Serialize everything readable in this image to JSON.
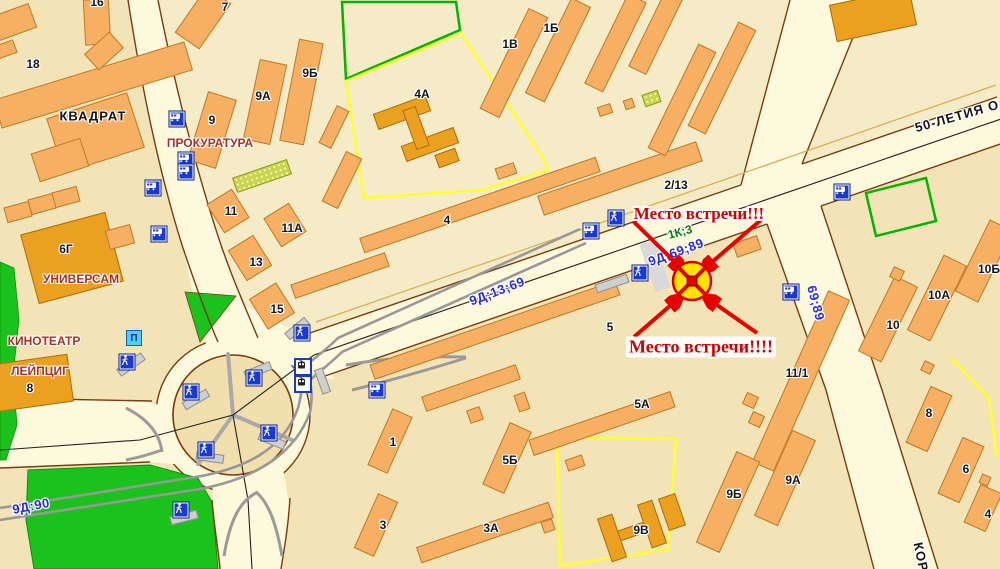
{
  "annotation": {
    "label_top": "Место встречи!!!",
    "label_bottom": "Место встречи!!!!",
    "marker": {
      "x": 692,
      "y": 281
    },
    "arrow_color": "#E60000",
    "marker_fill": "#FFE400",
    "marker_cross": "#DD0000"
  },
  "colors": {
    "block_base": "#F2E4B6",
    "block_light": "#F5EBC6",
    "road": "#FDF9DC",
    "road_edge": "#7A3B10",
    "building": "#F6AF63",
    "building_public": "#ECA01F",
    "park": "#1CC21C",
    "tram_track": "#989898",
    "street_text_blue": "#2A2ADF",
    "outline_green": "#00B400",
    "outline_yellow": "#FFFF30"
  },
  "street_labels": [
    {
      "t": "50-ЛЕТИЯ О",
      "x": 957,
      "y": 116,
      "r": -16,
      "c": "black"
    },
    {
      "t": "КОР",
      "x": 921,
      "y": 557,
      "r": 78,
      "c": "black"
    },
    {
      "t": "9Д;13;69",
      "x": 497,
      "y": 291,
      "r": -21,
      "c": "blue"
    },
    {
      "t": "9Д;69;89",
      "x": 676,
      "y": 252,
      "r": -20,
      "c": "blue"
    },
    {
      "t": "69;89",
      "x": 816,
      "y": 303,
      "r": 75,
      "c": "blue"
    },
    {
      "t": "9Д:90",
      "x": 31,
      "y": 506,
      "r": -11,
      "c": "blue"
    },
    {
      "t": "1К;3",
      "x": 680,
      "y": 232,
      "r": -15,
      "c": "green"
    }
  ],
  "poi_labels": [
    {
      "t": "КВАДРАТ",
      "x": 93,
      "y": 116,
      "c": "black"
    },
    {
      "t": "ПРОКУРАТУРА",
      "x": 210,
      "y": 143,
      "c": "red"
    },
    {
      "t": "УНИВЕРСАМ",
      "x": 81,
      "y": 279,
      "c": "red"
    },
    {
      "t": "КИНОТЕАТР",
      "x": 44,
      "y": 341,
      "c": "red"
    },
    {
      "t": "ЛЕЙПЦИГ",
      "x": 40,
      "y": 371,
      "c": "red"
    }
  ],
  "building_labels": [
    {
      "t": "18",
      "x": 33,
      "y": 64
    },
    {
      "t": "16",
      "x": 97,
      "y": 2
    },
    {
      "t": "7",
      "x": 225,
      "y": 7
    },
    {
      "t": "9Б",
      "x": 310,
      "y": 73
    },
    {
      "t": "9А",
      "x": 263,
      "y": 96
    },
    {
      "t": "9",
      "x": 212,
      "y": 120
    },
    {
      "t": "11",
      "x": 231,
      "y": 211
    },
    {
      "t": "11А",
      "x": 292,
      "y": 228
    },
    {
      "t": "13",
      "x": 256,
      "y": 262
    },
    {
      "t": "15",
      "x": 277,
      "y": 309
    },
    {
      "t": "6Г",
      "x": 66,
      "y": 249
    },
    {
      "t": "8",
      "x": 30,
      "y": 388
    },
    {
      "t": "4А",
      "x": 422,
      "y": 94
    },
    {
      "t": "1В",
      "x": 510,
      "y": 44
    },
    {
      "t": "1Б",
      "x": 551,
      "y": 28
    },
    {
      "t": "4",
      "x": 447,
      "y": 220
    },
    {
      "t": "2/13",
      "x": 676,
      "y": 185
    },
    {
      "t": "5",
      "x": 610,
      "y": 327
    },
    {
      "t": "5А",
      "x": 642,
      "y": 404
    },
    {
      "t": "5Б",
      "x": 510,
      "y": 460
    },
    {
      "t": "3А",
      "x": 491,
      "y": 528
    },
    {
      "t": "1",
      "x": 393,
      "y": 442
    },
    {
      "t": "3",
      "x": 383,
      "y": 525
    },
    {
      "t": "9В",
      "x": 641,
      "y": 530
    },
    {
      "t": "11/1",
      "x": 797,
      "y": 373
    },
    {
      "t": "9Б",
      "x": 734,
      "y": 494
    },
    {
      "t": "9А",
      "x": 793,
      "y": 480
    },
    {
      "t": "10",
      "x": 893,
      "y": 325
    },
    {
      "t": "10А",
      "x": 939,
      "y": 295
    },
    {
      "t": "10Б",
      "x": 989,
      "y": 269
    },
    {
      "t": "8",
      "x": 929,
      "y": 413
    },
    {
      "t": "6",
      "x": 966,
      "y": 469
    },
    {
      "t": "4",
      "x": 988,
      "y": 514
    }
  ],
  "icons": [
    {
      "k": "bus",
      "x": 177,
      "y": 119
    },
    {
      "k": "bus",
      "x": 153,
      "y": 188
    },
    {
      "k": "bus",
      "x": 159,
      "y": 234
    },
    {
      "k": "bus",
      "x": 186,
      "y": 160
    },
    {
      "k": "bus",
      "x": 186,
      "y": 172
    },
    {
      "k": "bus",
      "x": 591,
      "y": 231
    },
    {
      "k": "bus",
      "x": 842,
      "y": 192
    },
    {
      "k": "bus",
      "x": 791,
      "y": 292
    },
    {
      "k": "bus",
      "x": 377,
      "y": 390
    },
    {
      "k": "tram",
      "x": 303,
      "y": 367
    },
    {
      "k": "tram",
      "x": 303,
      "y": 384
    },
    {
      "k": "ped",
      "x": 616,
      "y": 218
    },
    {
      "k": "ped",
      "x": 640,
      "y": 273
    },
    {
      "k": "ped",
      "x": 127,
      "y": 362
    },
    {
      "k": "ped",
      "x": 191,
      "y": 392
    },
    {
      "k": "ped",
      "x": 254,
      "y": 378
    },
    {
      "k": "ped",
      "x": 269,
      "y": 433
    },
    {
      "k": "ped",
      "x": 206,
      "y": 450
    },
    {
      "k": "ped",
      "x": 181,
      "y": 510
    },
    {
      "k": "ped",
      "x": 302,
      "y": 333
    },
    {
      "k": "park",
      "x": 134,
      "y": 338,
      "label": "П"
    }
  ],
  "buildings": [
    {
      "x": 93,
      "y": 85,
      "w": 200,
      "h": 30,
      "r": -17
    },
    {
      "x": 14,
      "y": 22,
      "w": 40,
      "h": 26,
      "r": -20
    },
    {
      "x": 4,
      "y": 50,
      "w": 24,
      "h": 14,
      "r": -20
    },
    {
      "x": 97,
      "y": 22,
      "w": 26,
      "h": 46,
      "r": -3
    },
    {
      "x": 104,
      "y": 51,
      "w": 34,
      "h": 22,
      "r": -42
    },
    {
      "x": 95,
      "y": 133,
      "w": 85,
      "h": 58,
      "r": -18
    },
    {
      "x": 60,
      "y": 160,
      "w": 52,
      "h": 30,
      "r": -18
    },
    {
      "x": 203,
      "y": 18,
      "w": 56,
      "h": 30,
      "r": -55
    },
    {
      "x": 212,
      "y": 130,
      "w": 30,
      "h": 72,
      "r": 17
    },
    {
      "x": 265,
      "y": 102,
      "w": 28,
      "h": 82,
      "r": 12
    },
    {
      "x": 301,
      "y": 92,
      "w": 25,
      "h": 104,
      "r": 11
    },
    {
      "x": 228,
      "y": 211,
      "w": 30,
      "h": 34,
      "r": -32
    },
    {
      "x": 285,
      "y": 225,
      "w": 30,
      "h": 34,
      "r": -32
    },
    {
      "x": 250,
      "y": 258,
      "w": 30,
      "h": 36,
      "r": -32
    },
    {
      "x": 272,
      "y": 306,
      "w": 32,
      "h": 36,
      "r": -32
    },
    {
      "x": 262,
      "y": 176,
      "w": 58,
      "h": 16,
      "r": -19,
      "s": "h"
    },
    {
      "x": 651,
      "y": 98,
      "w": 17,
      "h": 13,
      "r": -19,
      "s": "h"
    },
    {
      "x": 402,
      "y": 112,
      "w": 56,
      "h": 17,
      "r": -20,
      "s": "d"
    },
    {
      "x": 430,
      "y": 144,
      "w": 56,
      "h": 17,
      "r": -20,
      "s": "d"
    },
    {
      "x": 416,
      "y": 128,
      "w": 14,
      "h": 42,
      "r": -20,
      "s": "d"
    },
    {
      "x": 447,
      "y": 158,
      "w": 22,
      "h": 14,
      "r": -20,
      "s": "d"
    },
    {
      "x": 514,
      "y": 63,
      "w": 22,
      "h": 112,
      "r": 26
    },
    {
      "x": 558,
      "y": 50,
      "w": 22,
      "h": 106,
      "r": 26
    },
    {
      "x": 615,
      "y": 43,
      "w": 21,
      "h": 100,
      "r": 26
    },
    {
      "x": 656,
      "y": 32,
      "w": 20,
      "h": 86,
      "r": 26
    },
    {
      "x": 334,
      "y": 127,
      "w": 14,
      "h": 42,
      "r": 26
    },
    {
      "x": 342,
      "y": 180,
      "w": 18,
      "h": 56,
      "r": 26
    },
    {
      "x": 620,
      "y": 178,
      "w": 168,
      "h": 21,
      "r": -19
    },
    {
      "x": 682,
      "y": 100,
      "w": 20,
      "h": 116,
      "r": 26
    },
    {
      "x": 722,
      "y": 78,
      "w": 20,
      "h": 116,
      "r": 26
    },
    {
      "x": 873,
      "y": 15,
      "w": 82,
      "h": 38,
      "r": -12,
      "s": "d"
    },
    {
      "x": 340,
      "y": 275,
      "w": 100,
      "h": 15,
      "r": -19
    },
    {
      "x": 480,
      "y": 205,
      "w": 250,
      "h": 16,
      "r": -19
    },
    {
      "x": 495,
      "y": 330,
      "w": 260,
      "h": 16,
      "r": -19
    },
    {
      "x": 471,
      "y": 388,
      "w": 100,
      "h": 16,
      "r": -19
    },
    {
      "x": 602,
      "y": 423,
      "w": 150,
      "h": 17,
      "r": -19
    },
    {
      "x": 485,
      "y": 532,
      "w": 140,
      "h": 17,
      "r": -19
    },
    {
      "x": 390,
      "y": 441,
      "w": 22,
      "h": 62,
      "r": 24
    },
    {
      "x": 376,
      "y": 525,
      "w": 22,
      "h": 60,
      "r": 24
    },
    {
      "x": 507,
      "y": 458,
      "w": 24,
      "h": 68,
      "r": 24
    },
    {
      "x": 475,
      "y": 415,
      "w": 14,
      "h": 14,
      "r": -19
    },
    {
      "x": 522,
      "y": 402,
      "w": 12,
      "h": 18,
      "r": -19
    },
    {
      "x": 575,
      "y": 463,
      "w": 18,
      "h": 12,
      "r": -19
    },
    {
      "x": 548,
      "y": 526,
      "w": 12,
      "h": 12,
      "r": -19
    },
    {
      "x": 506,
      "y": 171,
      "w": 20,
      "h": 12,
      "r": -19
    },
    {
      "x": 605,
      "y": 110,
      "w": 14,
      "h": 10,
      "r": -19
    },
    {
      "x": 629,
      "y": 104,
      "w": 10,
      "h": 10,
      "r": -19
    },
    {
      "x": 747,
      "y": 246,
      "w": 26,
      "h": 15,
      "r": -19
    },
    {
      "x": 612,
      "y": 538,
      "w": 16,
      "h": 46,
      "r": -19,
      "s": "d"
    },
    {
      "x": 652,
      "y": 524,
      "w": 16,
      "h": 46,
      "r": -19,
      "s": "d"
    },
    {
      "x": 632,
      "y": 531,
      "w": 28,
      "h": 11,
      "r": -19,
      "s": "d"
    },
    {
      "x": 672,
      "y": 512,
      "w": 18,
      "h": 34,
      "r": -19,
      "s": "d"
    },
    {
      "x": 801,
      "y": 381,
      "w": 24,
      "h": 188,
      "r": 24
    },
    {
      "x": 785,
      "y": 478,
      "w": 26,
      "h": 94,
      "r": 24
    },
    {
      "x": 728,
      "y": 502,
      "w": 26,
      "h": 100,
      "r": 24
    },
    {
      "x": 750,
      "y": 400,
      "w": 13,
      "h": 13,
      "r": 24
    },
    {
      "x": 756,
      "y": 419,
      "w": 13,
      "h": 13,
      "r": 24
    },
    {
      "x": 888,
      "y": 319,
      "w": 26,
      "h": 84,
      "r": 26
    },
    {
      "x": 937,
      "y": 298,
      "w": 26,
      "h": 84,
      "r": 26
    },
    {
      "x": 984,
      "y": 261,
      "w": 26,
      "h": 80,
      "r": 26
    },
    {
      "x": 897,
      "y": 274,
      "w": 12,
      "h": 12,
      "r": 26
    },
    {
      "x": 927,
      "y": 367,
      "w": 11,
      "h": 11,
      "r": 26
    },
    {
      "x": 929,
      "y": 419,
      "w": 24,
      "h": 62,
      "r": 24
    },
    {
      "x": 961,
      "y": 470,
      "w": 24,
      "h": 62,
      "r": 24
    },
    {
      "x": 983,
      "y": 508,
      "w": 24,
      "h": 42,
      "r": 24
    },
    {
      "x": 985,
      "y": 480,
      "w": 10,
      "h": 10,
      "r": 24
    },
    {
      "x": 18,
      "y": 212,
      "w": 26,
      "h": 16,
      "r": -15
    },
    {
      "x": 42,
      "y": 204,
      "w": 26,
      "h": 16,
      "r": -15
    },
    {
      "x": 66,
      "y": 197,
      "w": 26,
      "h": 16,
      "r": -15
    },
    {
      "x": 72,
      "y": 258,
      "w": 88,
      "h": 72,
      "r": -15,
      "s": "d"
    },
    {
      "x": 120,
      "y": 237,
      "w": 26,
      "h": 20,
      "r": -15
    },
    {
      "x": 32,
      "y": 383,
      "w": 78,
      "h": 48,
      "r": -8,
      "s": "d"
    },
    {
      "x": 612,
      "y": 283,
      "w": 34,
      "h": 9,
      "r": -19,
      "s": "p"
    },
    {
      "x": 131,
      "y": 364,
      "w": 30,
      "h": 9,
      "r": -35,
      "s": "p"
    },
    {
      "x": 196,
      "y": 399,
      "w": 28,
      "h": 9,
      "r": -30,
      "s": "p"
    },
    {
      "x": 258,
      "y": 370,
      "w": 28,
      "h": 9,
      "r": -22,
      "s": "p"
    },
    {
      "x": 272,
      "y": 440,
      "w": 28,
      "h": 9,
      "r": 22,
      "s": "p"
    },
    {
      "x": 210,
      "y": 457,
      "w": 28,
      "h": 9,
      "r": 8,
      "s": "p"
    },
    {
      "x": 184,
      "y": 517,
      "w": 28,
      "h": 9,
      "r": -14,
      "s": "p"
    },
    {
      "x": 297,
      "y": 328,
      "w": 26,
      "h": 9,
      "r": -40,
      "s": "p"
    },
    {
      "x": 322,
      "y": 381,
      "w": 9,
      "h": 26,
      "r": -20,
      "s": "p"
    }
  ]
}
